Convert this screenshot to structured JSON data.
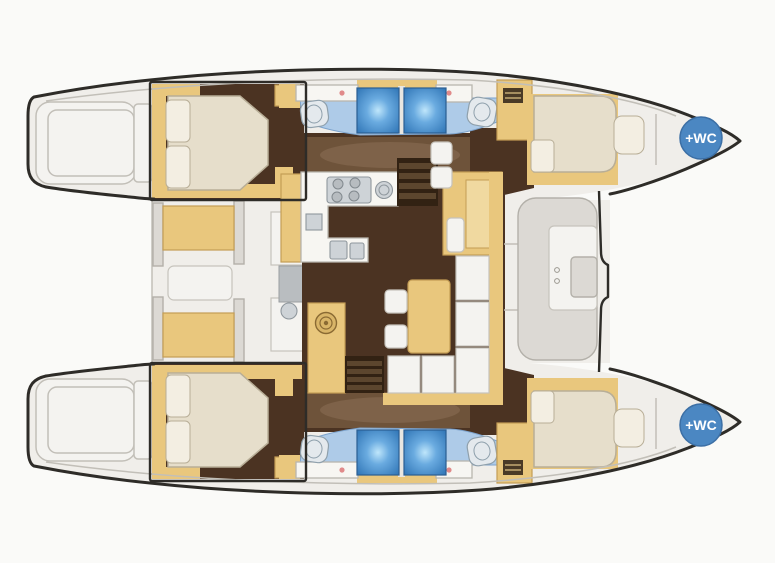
{
  "diagram": {
    "type": "catamaran-yacht-floor-plan-top-view",
    "badges": [
      {
        "label": "+WC",
        "location": "upper-hull-bow"
      },
      {
        "label": "+WC",
        "location": "lower-hull-bow"
      }
    ],
    "colors": {
      "background": "#fafaf8",
      "deck": "#f0eeea",
      "platform": "#f4f3f0",
      "hull_outline": "#2e2c28",
      "deck_line": "#c2bfb8",
      "cabin_floor": "#4b3322",
      "corridor_floor": "#6e533a",
      "floor_highlight": "#8d7257",
      "wood": "#e9c77d",
      "wood_edge": "#c49d55",
      "bed": "#e6decb",
      "bed_edge": "#b8ae97",
      "pillow": "#f3eee2",
      "counter": "#f7f6f2",
      "counter_edge": "#b9b6ae",
      "bath_floor": "#aecbe8",
      "bath_edge": "#7da3cc",
      "shower_dark": "#2f74b5",
      "shower_glow": "#bfe6fb",
      "fixture": "#e4e9ed",
      "fixture_edge": "#8fa0ac",
      "stairs_dark": "#322213",
      "stairs_light": "#5c462e",
      "badge": "#4b87c2",
      "badge_text": "#ffffff",
      "faucet": "#e08a8a"
    }
  }
}
